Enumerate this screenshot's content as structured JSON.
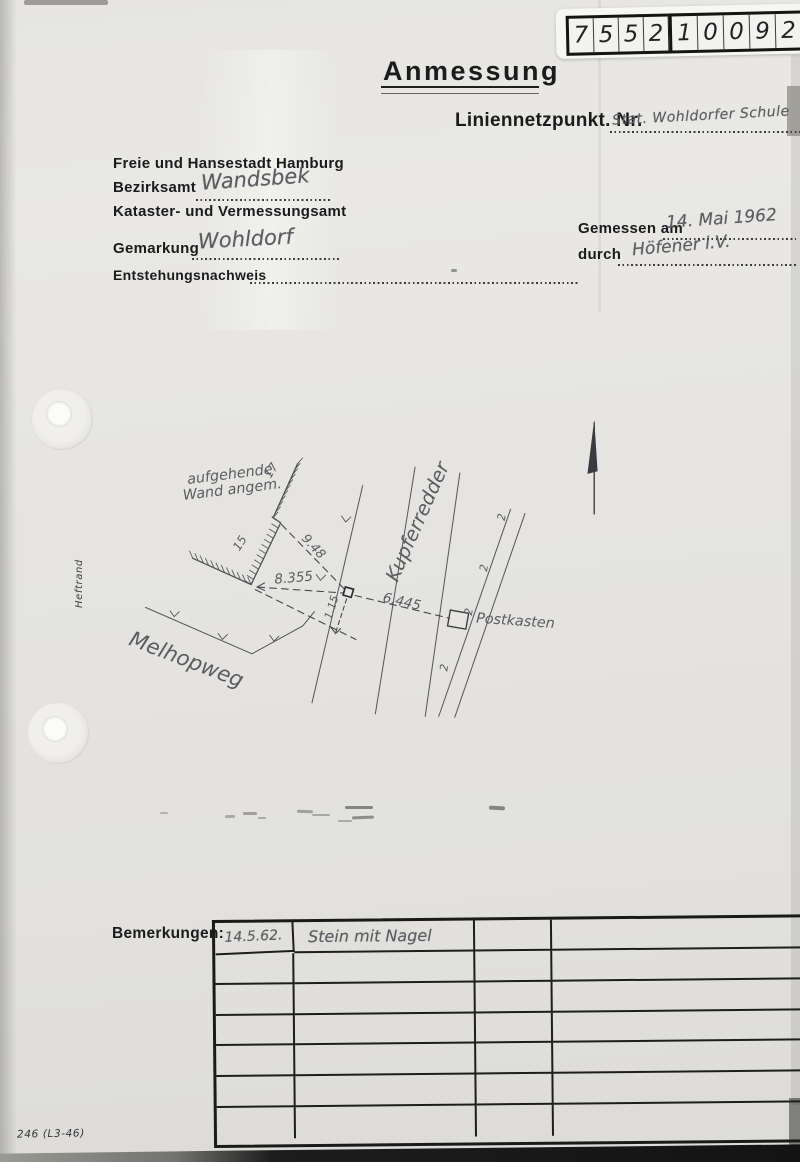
{
  "colors": {
    "paper": "#e5e4e0",
    "pencil": "#5c5c63",
    "ink": "#24242a",
    "line": "#4c4c54"
  },
  "sticker": {
    "digits": [
      "7",
      "5",
      "5",
      "2",
      "1",
      "0",
      "0",
      "9",
      "2",
      "5"
    ]
  },
  "header": {
    "title": "Anmessung",
    "point_label": "Liniennetzpunkt. Nr.",
    "point_value": "Stat. Wohldorfer Schule",
    "authority_line1": "Freie und Hansestadt Hamburg",
    "district_label": "Bezirksamt",
    "district_value": "Wandsbek",
    "authority_line2": "Kataster- und Vermessungsamt",
    "gemarkung_label": "Gemarkung",
    "gemarkung_value": "Wohldorf",
    "origin_label": "Entstehungsnachweis",
    "measured_label": "Gemessen am",
    "measured_value": "14. Mai 1962",
    "by_label": "durch",
    "by_value": "Höfener i.V."
  },
  "margin_label": "Heftrand",
  "sketch": {
    "wall_note_line1": "aufgehende",
    "wall_note_line2": "Wand angem.",
    "wall_no_upper": "17",
    "wall_no_lower": "15",
    "dim_wall": "9.48",
    "dim_left": "8.355",
    "dim_right": "6.445",
    "dim_offset": "1.15",
    "street_main": "Kupferredder",
    "street_bottom": "Melhopweg",
    "object_label": "Postkasten",
    "fence_mark": "2"
  },
  "remarks": {
    "label": "Bemerkungen:",
    "rows": [
      {
        "c0": "14.5.62.",
        "c1": "Stein mit Nagel",
        "c2": "",
        "c3": ""
      },
      {
        "c0": "",
        "c1": "",
        "c2": "",
        "c3": ""
      },
      {
        "c0": "",
        "c1": "",
        "c2": "",
        "c3": ""
      },
      {
        "c0": "",
        "c1": "",
        "c2": "",
        "c3": ""
      },
      {
        "c0": "",
        "c1": "",
        "c2": "",
        "c3": ""
      },
      {
        "c0": "",
        "c1": "",
        "c2": "",
        "c3": ""
      },
      {
        "c0": "",
        "c1": "",
        "c2": "",
        "c3": ""
      }
    ]
  },
  "form_number": "246 (L3-46)"
}
